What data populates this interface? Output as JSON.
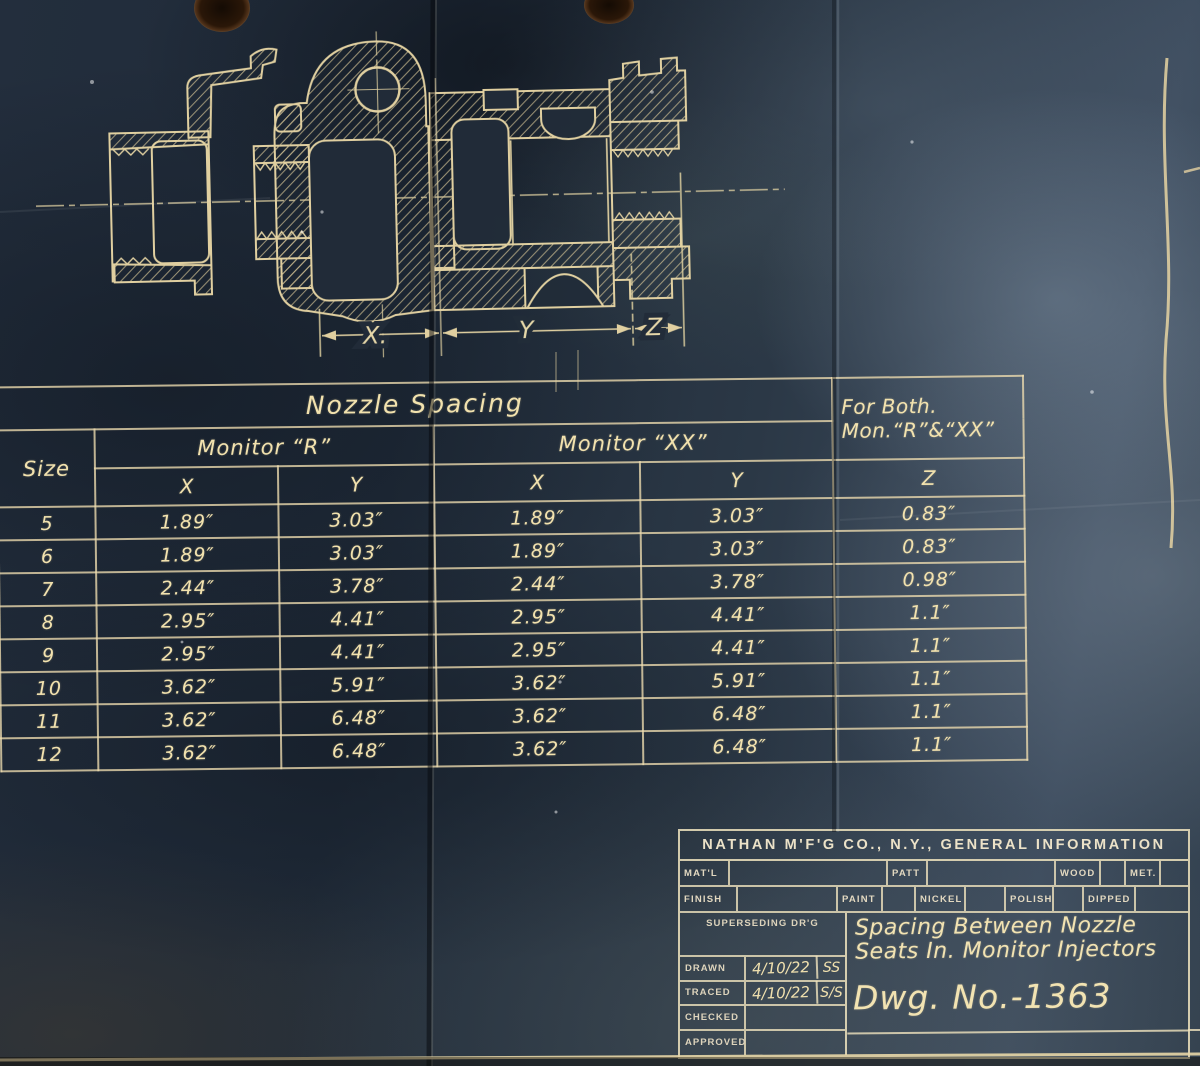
{
  "page": {
    "background_color": "#27323f",
    "line_color": "#e8d6a4",
    "description": "Vintage blueprint - spacing between nozzle seats in Monitor injectors"
  },
  "drawing": {
    "dim_x": "X.",
    "dim_y": "Y",
    "dim_z": "Z"
  },
  "table": {
    "title": "Nozzle Spacing",
    "for_both_line1": "For Both.",
    "for_both_line2": "Mon.“R”&“XX”",
    "size_header": "Size",
    "monitor_r": "Monitor “R”",
    "monitor_xx": "Monitor “XX”",
    "col_x": "X",
    "col_y": "Y",
    "col_z": "Z",
    "rows": [
      {
        "size": "5",
        "r_x": "1.89″",
        "r_y": "3.03″",
        "xx_x": "1.89″",
        "xx_y": "3.03″",
        "z": "0.83″"
      },
      {
        "size": "6",
        "r_x": "1.89″",
        "r_y": "3.03″",
        "xx_x": "1.89″",
        "xx_y": "3.03″",
        "z": "0.83″"
      },
      {
        "size": "7",
        "r_x": "2.44″",
        "r_y": "3.78″",
        "xx_x": "2.44″",
        "xx_y": "3.78″",
        "z": "0.98″"
      },
      {
        "size": "8",
        "r_x": "2.95″",
        "r_y": "4.41″",
        "xx_x": "2.95″",
        "xx_y": "4.41″",
        "z": "1.1″"
      },
      {
        "size": "9",
        "r_x": "2.95″",
        "r_y": "4.41″",
        "xx_x": "2.95″",
        "xx_y": "4.41″",
        "z": "1.1″"
      },
      {
        "size": "10",
        "r_x": "3.62″",
        "r_y": "5.91″",
        "xx_x": "3.62″",
        "xx_y": "5.91″",
        "z": "1.1″"
      },
      {
        "size": "11",
        "r_x": "3.62″",
        "r_y": "6.48″",
        "xx_x": "3.62″",
        "xx_y": "6.48″",
        "z": "1.1″"
      },
      {
        "size": "12",
        "r_x": "3.62″",
        "r_y": "6.48″",
        "xx_x": "3.62″",
        "xx_y": "6.48″",
        "z": "1.1″"
      }
    ]
  },
  "title_block": {
    "company": "NATHAN M'F'G CO., N.Y., GENERAL INFORMATION",
    "matl": "MAT'L",
    "patt": "PATT",
    "wood": "WOOD",
    "met": "MET.",
    "finish": "FINISH",
    "paint": "PAINT",
    "nickel": "NICKEL",
    "polish": "POLISH",
    "dipped": "DIPPED",
    "superseding": "SUPERSEDING DR'G",
    "title_line1": "Spacing Between Nozzle",
    "title_line2": "Seats In. Monitor Injectors",
    "drawn_label": "DRAWN",
    "drawn_date": "4/10/22",
    "drawn_initials": "SS",
    "traced_label": "TRACED",
    "traced_date": "4/10/22",
    "traced_initials": "S/S",
    "checked_label": "CHECKED",
    "approved_label": "APPROVED",
    "dwg_no": "Dwg. No.-1363"
  }
}
